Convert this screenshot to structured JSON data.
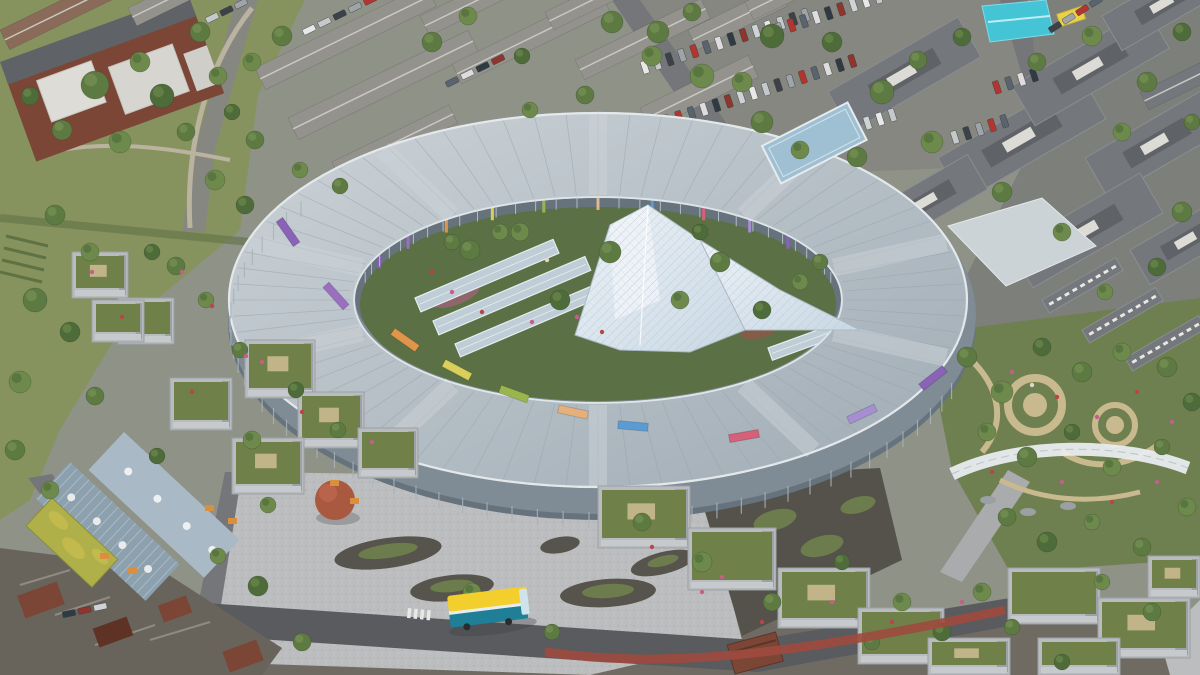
{
  "meta": {
    "description": "Aerial architectural rendering of a large oval children's hospital building with central glass atrium, courtyard gardens, surrounding city streets, terraced houses, parking lots, public plaza and rooftop gardens",
    "type": "architectural-rendering",
    "visible_text": []
  },
  "palette": {
    "baseGround": "#8e9287",
    "parkGrass": "#87935f",
    "grassDark": "#5f7244",
    "asphalt": "#858780",
    "roadMid": "#74767a",
    "roadDark": "#595b5e",
    "bottomStrip": "#6f6b63",
    "clusterDark": "#68645c",
    "paving": "#bcbdbe",
    "pavingLight": "#cfd0d0",
    "pavingShade": "#a3a4a6",
    "islandDark": "#56544c",
    "islandGreen": "#6c7c4c",
    "gardenGreen": "#6e7f50",
    "courtDark": "#54524b",
    "facade": "#7f8b95",
    "facadeDark": "#66727c",
    "mullion": "#aab3ba",
    "courtGreen": "#5c7045",
    "ovalRoof": "#9fabb4",
    "ovalRoofLight": "#ccd3d8",
    "ovalRib": "#98a2ab",
    "glassStrip": "#bfcdd6",
    "glassStripEdge": "#e6edf1",
    "crystal": "#c9d8e4",
    "crystalLight": "#eef3f8",
    "crystalLine": "#a9bac7",
    "linkRoof": "#9fc0d2",
    "linkPale": "#ccd3d7",
    "canopyWhite": "#e8ecee",
    "pathBeige": "#c9b98f",
    "slate": "#74777b",
    "slateLight": "#8b8e91",
    "slateDark": "#5f6266",
    "houseRoof": "#93928c",
    "houseRoofLight": "#c9c8c2",
    "houseBrick": "#8a6a58",
    "brick": "#7c4636",
    "brickDark": "#5e3326",
    "blockFacade": "#9ba1a5",
    "blockFacadeLight": "#b8bcbe",
    "roofGarden": "#6f8148",
    "metalRoof": "#8da0ae",
    "metalRoofLight": "#a9bac6",
    "sedum": "#b0b04a",
    "sedumLight": "#c8bd4e",
    "tentCyan": "#45c4d6",
    "vanYellow": "#e8d24a",
    "busYellow": "#f2cf2c",
    "busTeal": "#1f7f96",
    "busWhite": "#e8eef0",
    "busLane": "#9e4a3e",
    "treeRed": "#a85940",
    "treeGreens": [
      "#4e6b3a",
      "#5d7a42",
      "#6d8a4c",
      "#7a9455"
    ],
    "flowerColors": [
      "#c75e8a",
      "#b9454a",
      "#ddd8cf"
    ],
    "finColors": [
      "#8a63b8",
      "#9a6fc0",
      "#e0964a",
      "#d9cf5a",
      "#9ab54e",
      "#e5b07a",
      "#5a9bd4",
      "#d4607a",
      "#a58fd0"
    ],
    "carColors": [
      "#e8e8e8",
      "#c6c9cc",
      "#3c4248",
      "#9ea4a8",
      "#b33530",
      "#5a646e",
      "#dddddd",
      "#2f3a42",
      "#8f342e",
      "#cfd3d6"
    ]
  },
  "scene": {
    "oval": {
      "cx": 598,
      "cy": 300,
      "rxo": 366,
      "ryo": 186,
      "rxi": 248,
      "ryi": 105
    },
    "roofBands": [
      18,
      54,
      90,
      126,
      162,
      198,
      234,
      270,
      306,
      342
    ],
    "innerAccentAngles": [
      205,
      218,
      231,
      244,
      257,
      270,
      283,
      296,
      309,
      322,
      335
    ],
    "fins": [
      [
        288,
        232,
        -35,
        0
      ],
      [
        336,
        296,
        -42,
        1
      ],
      [
        405,
        340,
        -55,
        2
      ],
      [
        457,
        370,
        -62,
        3
      ],
      [
        514,
        394,
        -70,
        4
      ],
      [
        573,
        412,
        -78,
        5
      ],
      [
        633,
        426,
        -85,
        6
      ],
      [
        744,
        436,
        -100,
        7
      ],
      [
        862,
        414,
        -115,
        8
      ],
      [
        933,
        378,
        -128,
        0
      ]
    ],
    "greenhouses": [
      [
        415,
        298,
        150,
        15,
        -23
      ],
      [
        433,
        321,
        165,
        15,
        -23
      ],
      [
        455,
        344,
        172,
        14,
        -23
      ],
      [
        768,
        348,
        105,
        13,
        -20
      ],
      [
        790,
        368,
        106,
        12,
        -20
      ]
    ],
    "houseRows": [
      [
        0,
        30,
        130,
        22,
        -26,
        2
      ],
      [
        128,
        8,
        115,
        20,
        -26,
        0
      ],
      [
        255,
        68,
        190,
        24,
        -26,
        0
      ],
      [
        288,
        118,
        200,
        24,
        -26,
        0
      ],
      [
        332,
        162,
        130,
        20,
        -26,
        0
      ],
      [
        420,
        16,
        150,
        22,
        -26,
        0
      ],
      [
        452,
        64,
        165,
        22,
        -26,
        0
      ],
      [
        545,
        12,
        130,
        20,
        -26,
        0
      ],
      [
        575,
        60,
        140,
        22,
        -26,
        0
      ],
      [
        640,
        108,
        120,
        24,
        -26,
        0
      ],
      [
        688,
        30,
        100,
        22,
        -26,
        0
      ],
      [
        745,
        2,
        90,
        20,
        -26,
        0
      ],
      [
        1140,
        92,
        92,
        20,
        -26,
        1
      ]
    ],
    "slateBlocks": [
      [
        828,
        92,
        150,
        46,
        -30,
        0
      ],
      [
        938,
        158,
        165,
        50,
        -30,
        0
      ],
      [
        1012,
        86,
        155,
        46,
        -30,
        0
      ],
      [
        1085,
        158,
        140,
        46,
        -30,
        0
      ],
      [
        1102,
        16,
        120,
        40,
        -30,
        0
      ],
      [
        1010,
        248,
        150,
        46,
        -30,
        0
      ],
      [
        868,
        212,
        115,
        40,
        -30,
        0
      ],
      [
        1130,
        250,
        110,
        40,
        -30,
        0
      ],
      [
        1042,
        300,
        85,
        15,
        -30,
        1
      ],
      [
        1082,
        330,
        85,
        15,
        -30,
        1
      ],
      [
        1125,
        358,
        85,
        15,
        -30,
        1
      ]
    ],
    "carRows": [
      [
        640,
        62,
        -18,
        14,
        13,
        1,
        0
      ],
      [
        662,
        116,
        -18,
        16,
        13,
        1,
        3
      ],
      [
        702,
        170,
        -18,
        16,
        13,
        1,
        6
      ],
      [
        762,
        28,
        -18,
        10,
        13,
        1,
        2
      ],
      [
        950,
        132,
        -18,
        5,
        13,
        1,
        1
      ],
      [
        992,
        82,
        -18,
        4,
        13,
        1,
        4
      ],
      [
        302,
        30,
        -26,
        5,
        17,
        0,
        0
      ],
      [
        445,
        82,
        -26,
        4,
        17,
        0,
        5
      ],
      [
        1048,
        28,
        -32,
        4,
        16,
        0,
        2
      ],
      [
        62,
        612,
        -12,
        3,
        16,
        0,
        7
      ],
      [
        205,
        18,
        -26,
        3,
        16,
        0,
        1
      ]
    ],
    "gardenBlocks": [
      [
        245,
        340,
        70,
        58
      ],
      [
        170,
        378,
        62,
        52
      ],
      [
        298,
        392,
        66,
        56
      ],
      [
        358,
        428,
        60,
        50
      ],
      [
        232,
        438,
        72,
        56
      ],
      [
        118,
        298,
        56,
        46
      ],
      [
        72,
        252,
        56,
        46
      ],
      [
        92,
        300,
        52,
        42
      ],
      [
        598,
        486,
        92,
        62
      ],
      [
        688,
        528,
        88,
        62
      ],
      [
        778,
        568,
        92,
        60
      ],
      [
        858,
        608,
        86,
        56
      ],
      [
        928,
        638,
        82,
        37
      ],
      [
        1008,
        568,
        92,
        56
      ],
      [
        1098,
        598,
        92,
        60
      ],
      [
        1038,
        638,
        82,
        37
      ],
      [
        1148,
        556,
        52,
        42
      ]
    ],
    "trees": [
      [
        95,
        85,
        14,
        1
      ],
      [
        140,
        62,
        10,
        2
      ],
      [
        162,
        96,
        12,
        0
      ],
      [
        200,
        32,
        10,
        1
      ],
      [
        218,
        76,
        9,
        2
      ],
      [
        62,
        130,
        10,
        1
      ],
      [
        30,
        96,
        9,
        0
      ],
      [
        120,
        142,
        11,
        2
      ],
      [
        186,
        132,
        9,
        1
      ],
      [
        232,
        112,
        8,
        0
      ],
      [
        252,
        62,
        9,
        2
      ],
      [
        282,
        36,
        10,
        1
      ],
      [
        255,
        140,
        9,
        1
      ],
      [
        215,
        180,
        10,
        2
      ],
      [
        245,
        205,
        9,
        0
      ],
      [
        55,
        215,
        10,
        1
      ],
      [
        90,
        252,
        9,
        2
      ],
      [
        35,
        300,
        12,
        1
      ],
      [
        70,
        332,
        10,
        0
      ],
      [
        20,
        382,
        11,
        2
      ],
      [
        95,
        396,
        9,
        1
      ],
      [
        15,
        450,
        10,
        1
      ],
      [
        50,
        490,
        9,
        2
      ],
      [
        432,
        42,
        10,
        1
      ],
      [
        468,
        16,
        9,
        2
      ],
      [
        522,
        56,
        8,
        0
      ],
      [
        612,
        22,
        11,
        1
      ],
      [
        652,
        56,
        10,
        2
      ],
      [
        692,
        12,
        9,
        1
      ],
      [
        772,
        36,
        12,
        0
      ],
      [
        742,
        82,
        10,
        2
      ],
      [
        585,
        95,
        9,
        1
      ],
      [
        530,
        110,
        8,
        2
      ],
      [
        658,
        32,
        11,
        1
      ],
      [
        702,
        76,
        12,
        2
      ],
      [
        762,
        122,
        11,
        1
      ],
      [
        832,
        42,
        10,
        0
      ],
      [
        882,
        92,
        12,
        1
      ],
      [
        932,
        142,
        11,
        2
      ],
      [
        857,
        157,
        10,
        1
      ],
      [
        962,
        37,
        9,
        0
      ],
      [
        800,
        150,
        9,
        2
      ],
      [
        918,
        60,
        9,
        1
      ],
      [
        1037,
        62,
        9,
        1
      ],
      [
        1092,
        36,
        10,
        2
      ],
      [
        1147,
        82,
        10,
        1
      ],
      [
        1182,
        32,
        9,
        0
      ],
      [
        1122,
        132,
        9,
        2
      ],
      [
        1192,
        122,
        8,
        1
      ],
      [
        1002,
        192,
        10,
        1
      ],
      [
        1062,
        232,
        9,
        2
      ],
      [
        1182,
        212,
        10,
        1
      ],
      [
        1157,
        267,
        9,
        0
      ],
      [
        1105,
        292,
        8,
        2
      ],
      [
        967,
        357,
        10,
        1
      ],
      [
        1002,
        392,
        11,
        2
      ],
      [
        1042,
        347,
        9,
        0
      ],
      [
        1082,
        372,
        10,
        1
      ],
      [
        1122,
        352,
        9,
        2
      ],
      [
        1167,
        367,
        10,
        1
      ],
      [
        1192,
        402,
        9,
        0
      ],
      [
        987,
        432,
        9,
        2
      ],
      [
        1027,
        457,
        10,
        1
      ],
      [
        1072,
        432,
        8,
        0
      ],
      [
        1112,
        467,
        9,
        2
      ],
      [
        1162,
        447,
        8,
        1
      ],
      [
        1187,
        507,
        9,
        2
      ],
      [
        1007,
        517,
        9,
        1
      ],
      [
        1047,
        542,
        10,
        0
      ],
      [
        1092,
        522,
        8,
        2
      ],
      [
        1142,
        547,
        9,
        1
      ],
      [
        470,
        250,
        10,
        1
      ],
      [
        520,
        232,
        9,
        2
      ],
      [
        560,
        300,
        10,
        0
      ],
      [
        610,
        252,
        11,
        1
      ],
      [
        680,
        300,
        9,
        2
      ],
      [
        720,
        262,
        10,
        1
      ],
      [
        762,
        310,
        9,
        0
      ],
      [
        800,
        282,
        8,
        2
      ],
      [
        452,
        242,
        8,
        1
      ],
      [
        700,
        232,
        8,
        0
      ],
      [
        820,
        262,
        8,
        1
      ],
      [
        500,
        232,
        8,
        2
      ],
      [
        176,
        266,
        9,
        1
      ],
      [
        206,
        300,
        8,
        2
      ],
      [
        240,
        350,
        8,
        1
      ],
      [
        152,
        252,
        8,
        0
      ],
      [
        300,
        170,
        8,
        2
      ],
      [
        340,
        186,
        8,
        1
      ],
      [
        296,
        390,
        8,
        0
      ],
      [
        302,
        642,
        9,
        1
      ],
      [
        472,
        592,
        9,
        2
      ],
      [
        552,
        632,
        8,
        1
      ],
      [
        258,
        586,
        10,
        0
      ],
      [
        218,
        556,
        8,
        2
      ],
      [
        338,
        430,
        8,
        1
      ],
      [
        252,
        440,
        9,
        2
      ],
      [
        157,
        456,
        8,
        0
      ],
      [
        268,
        505,
        8,
        2
      ],
      [
        642,
        522,
        9,
        1
      ],
      [
        702,
        562,
        10,
        2
      ],
      [
        772,
        602,
        9,
        1
      ],
      [
        842,
        562,
        8,
        0
      ],
      [
        902,
        602,
        9,
        2
      ],
      [
        872,
        642,
        8,
        1
      ],
      [
        942,
        632,
        9,
        0
      ],
      [
        982,
        592,
        9,
        2
      ],
      [
        1012,
        627,
        8,
        1
      ],
      [
        1102,
        582,
        8,
        2
      ],
      [
        1152,
        612,
        9,
        1
      ],
      [
        1062,
        662,
        8,
        0
      ]
    ],
    "flowers": [
      [
        452,
        292,
        0
      ],
      [
        482,
        312,
        1
      ],
      [
        532,
        322,
        0
      ],
      [
        432,
        272,
        1
      ],
      [
        577,
        317,
        0
      ],
      [
        602,
        332,
        1
      ],
      [
        547,
        260,
        2
      ],
      [
        1012,
        372,
        0
      ],
      [
        1057,
        397,
        1
      ],
      [
        1097,
        417,
        0
      ],
      [
        1137,
        392,
        1
      ],
      [
        1172,
        422,
        0
      ],
      [
        992,
        472,
        1
      ],
      [
        1062,
        482,
        0
      ],
      [
        1112,
        502,
        1
      ],
      [
        1157,
        482,
        0
      ],
      [
        1032,
        385,
        2
      ],
      [
        702,
        592,
        0
      ],
      [
        762,
        622,
        1
      ],
      [
        832,
        602,
        0
      ],
      [
        892,
        622,
        1
      ],
      [
        962,
        602,
        0
      ],
      [
        652,
        547,
        1
      ],
      [
        722,
        577,
        0
      ],
      [
        262,
        362,
        0
      ],
      [
        302,
        412,
        1
      ],
      [
        372,
        442,
        0
      ],
      [
        192,
        392,
        1
      ],
      [
        92,
        272,
        0
      ],
      [
        122,
        317,
        1
      ],
      [
        182,
        272,
        0
      ],
      [
        212,
        306,
        1
      ],
      [
        246,
        356,
        0
      ]
    ]
  }
}
